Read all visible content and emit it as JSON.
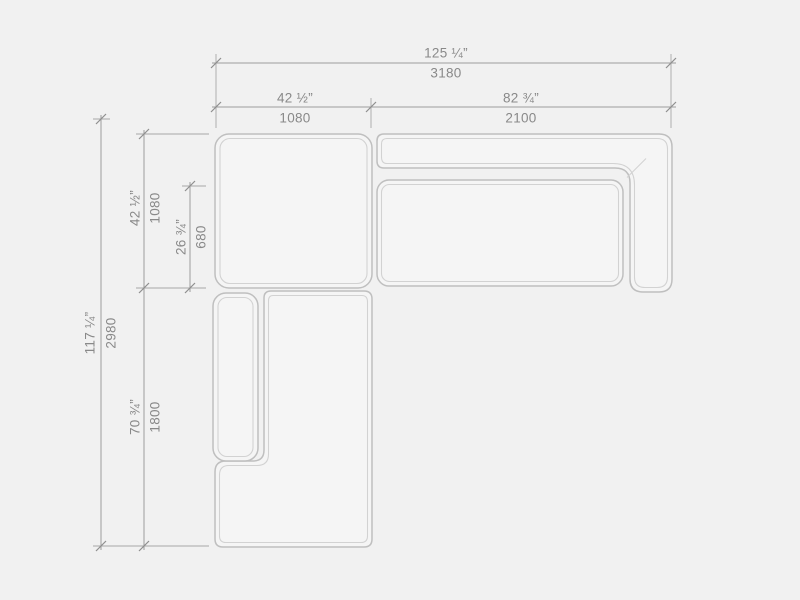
{
  "diagram": {
    "subject": "sectional-sofa-top-view",
    "view": "plan",
    "units_primary": "inches",
    "units_secondary": "mm"
  },
  "dimensions": {
    "overall_width": {
      "inches": "125 ¼”",
      "mm": "3180"
    },
    "left_section_width": {
      "inches": "42 ½”",
      "mm": "1080"
    },
    "right_section_width": {
      "inches": "82 ¾”",
      "mm": "2100"
    },
    "overall_depth": {
      "inches": "117 ¼”",
      "mm": "2980"
    },
    "corner_section_depth": {
      "inches": "42 ½”",
      "mm": "1080"
    },
    "seat_depth": {
      "inches": "26 ¾”",
      "mm": "680"
    },
    "chaise_length": {
      "inches": "70 ¾”",
      "mm": "1800"
    }
  },
  "parts": [
    "corner-seat",
    "backrest-and-right-armrest",
    "right-seat-cushion",
    "chaise-armrest",
    "chaise-seat"
  ],
  "colors": {
    "background": "#f1f1f1",
    "sofa_fill": "#f5f5f5",
    "sofa_outline": "#bfbfbf",
    "sofa_inner_line": "#d2d2d2",
    "dimension_line": "#9d9d9d",
    "text": "#898989"
  }
}
